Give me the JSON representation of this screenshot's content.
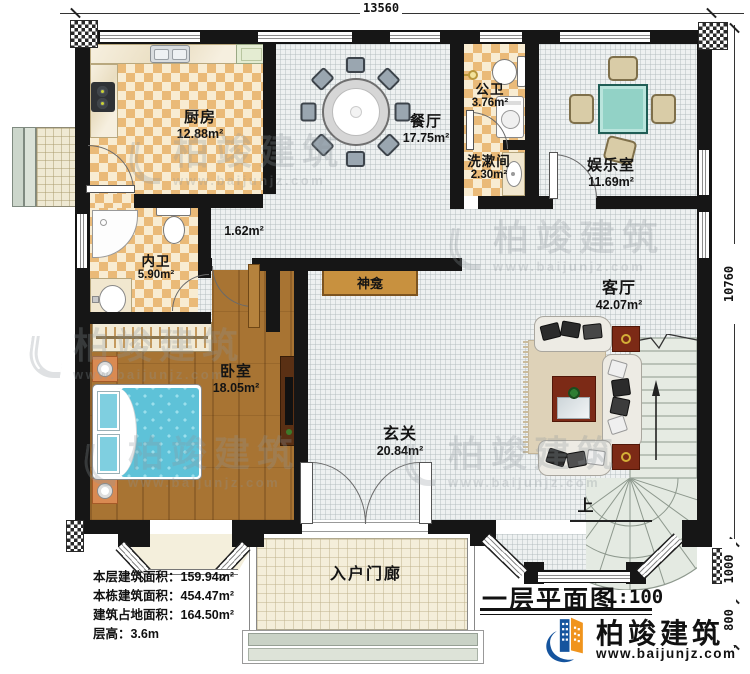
{
  "dimensions": {
    "top": "13560",
    "right": "10760",
    "right_mid": "1000",
    "right_bottom": "800"
  },
  "rooms": {
    "kitchen": {
      "name": "厨房",
      "area": "12.88m²"
    },
    "dining": {
      "name": "餐厅",
      "area": "17.75m²"
    },
    "public_bath": {
      "name": "公卫",
      "area": "3.76m²"
    },
    "washroom": {
      "name": "洗漱间",
      "area": "2.30m²"
    },
    "entertainment": {
      "name": "娱乐室",
      "area": "11.69m²"
    },
    "inner_bath": {
      "name": "内卫",
      "area": "5.90m²"
    },
    "hall_small": {
      "area": "1.62m²"
    },
    "bedroom": {
      "name": "卧室",
      "area": "18.05m²"
    },
    "shrine": {
      "name": "神龛"
    },
    "foyer": {
      "name": "玄关",
      "area": "20.84m²"
    },
    "living": {
      "name": "客厅",
      "area": "42.07m²"
    },
    "porch": {
      "name": "入户门廊"
    }
  },
  "stairs": {
    "up_label": "上"
  },
  "info": {
    "l1": "本层建筑面积：159.94m²",
    "l2": "本栋建筑面积：454.47m²",
    "l3": "建筑占地面积：164.50m²",
    "l4": "层高：3.6m"
  },
  "titleblock": {
    "title": "一层平面图",
    "scale": "1:100"
  },
  "brand": {
    "name": "柏竣建筑",
    "url": "www.baijunjz.com"
  },
  "watermark": {
    "name": "柏竣建筑",
    "url": "www.baijunjz.com"
  },
  "colors": {
    "wall": "#161616",
    "brand_blue": "#15549e",
    "brand_orange": "#f0941d",
    "bed": "#5ec2d8",
    "checker": "#eaba78"
  }
}
